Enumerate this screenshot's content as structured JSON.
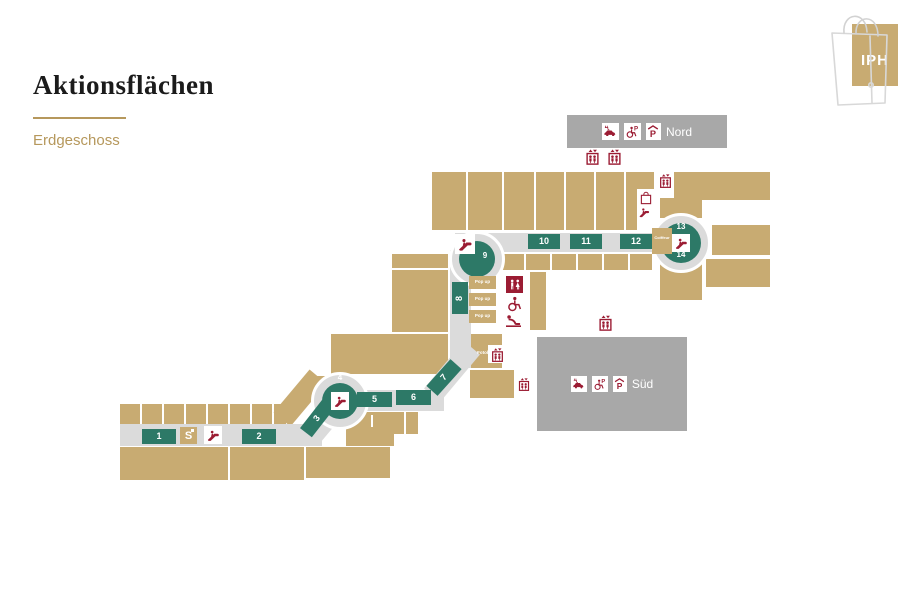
{
  "header": {
    "title": "Aktionsflächen",
    "subtitle": "Erdgeschoss"
  },
  "logo": {
    "text": "IPH"
  },
  "zones": {
    "nord": "Nord",
    "sued": "Süd"
  },
  "areas": {
    "a1": "1",
    "a2": "2",
    "a3": "3",
    "a4": "4",
    "a5": "5",
    "a6": "6",
    "a7": "7",
    "a8": "8",
    "a9": "9",
    "a10": "10",
    "a11": "11",
    "a12": "12",
    "a13": "13",
    "a14": "14"
  },
  "labels": {
    "popup": "Pop up",
    "fotobox": "Fotobox",
    "coiffeur": "Coiffeur",
    "bank": "S"
  },
  "icons": {
    "escalator": "escalator-icon",
    "elevator": "elevator-icon",
    "wc": "wc-icon",
    "wc_accessible": "accessible-wc-icon",
    "baby_changing": "baby-changing-icon",
    "parking_car": "car-charging-icon",
    "parking_accessible": "accessible-parking-icon",
    "parking_covered": "covered-parking-icon",
    "shopping_bag": "shopping-bag-icon",
    "bank_logo": "sparkasse-icon"
  },
  "colors": {
    "tan": "#c8ab72",
    "corridor": "#dbdbdb",
    "zone": "#a8a8a8",
    "green": "#2d7967",
    "red": "#9b1c33",
    "gold": "#b6985c",
    "title": "#1b1b1b"
  }
}
